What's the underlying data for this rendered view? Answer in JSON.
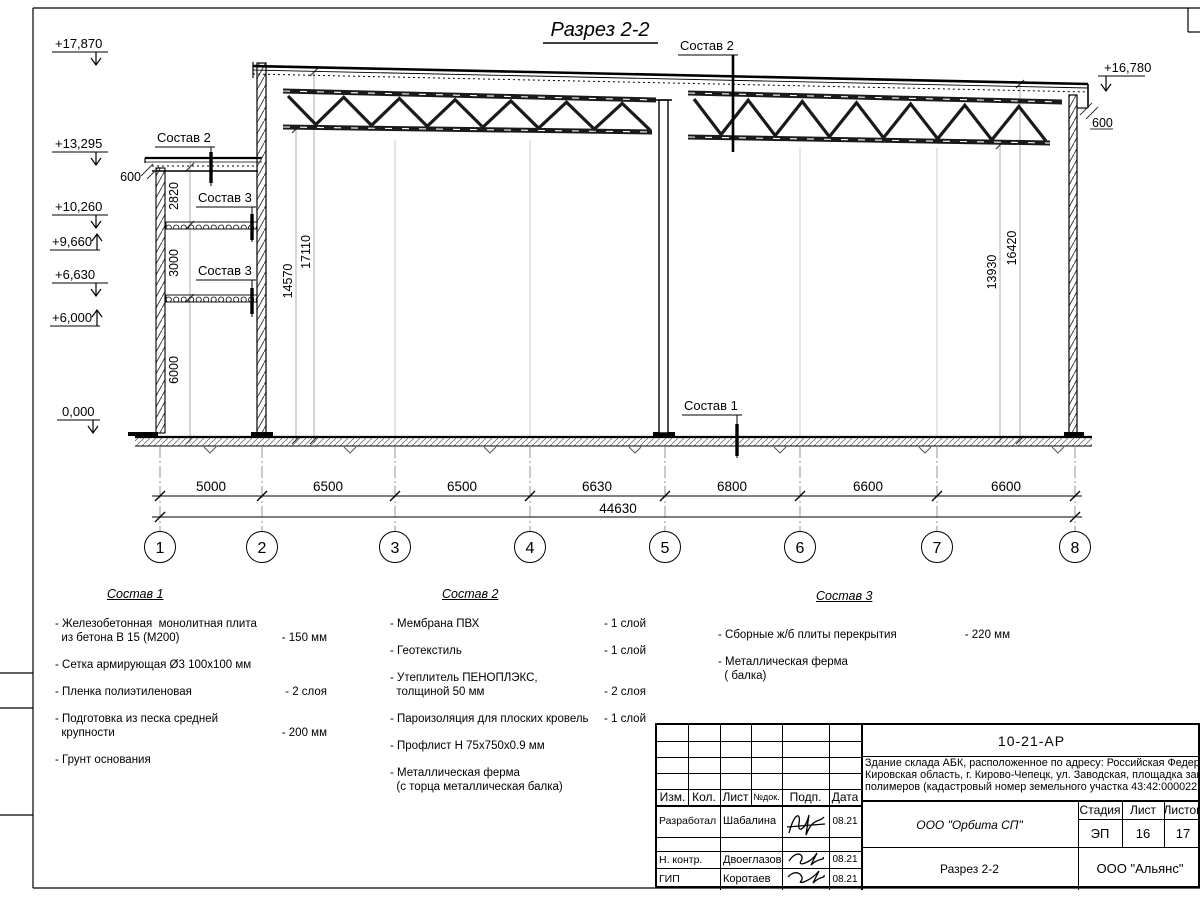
{
  "drawing": {
    "title": "Разрез 2-2",
    "elevation_marks": {
      "m17870": "+17,870",
      "m13295": "+13,295",
      "m10260": "+10,260",
      "m9660": "+9,660",
      "m6630": "+6,630",
      "m6000": "+6,000",
      "m0": "0,000",
      "m16780": "+16,780"
    },
    "callouts": {
      "sostav1": "Состав 1",
      "sostav2_left": "Состав 2",
      "sostav2_main": "Состав 2",
      "sostav3_upper": "Состав 3",
      "sostav3_lower": "Состав 3",
      "edge_left": "600",
      "edge_right": "600"
    },
    "dims_vertical": {
      "annex_top": "2820",
      "annex_mid": "3000",
      "annex_bottom": "6000",
      "left_clear": "14570",
      "left_full": "17110",
      "right_clear": "13930",
      "right_full": "16420"
    },
    "dims_horizontal": {
      "spans": [
        "5000",
        "6500",
        "6500",
        "6630",
        "6800",
        "6600",
        "6600"
      ],
      "total": "44630"
    },
    "axes": [
      "1",
      "2",
      "3",
      "4",
      "5",
      "6",
      "7",
      "8"
    ]
  },
  "legend": {
    "sostav1": {
      "title": "Состав 1",
      "items": [
        {
          "name": "- Железобетонная  монолитная плита\n  из бетона В 15 (М200)",
          "value": "- 150 мм"
        },
        {
          "name": "- Сетка армирующая Ø3 100х100 мм",
          "value": ""
        },
        {
          "name": "- Пленка полиэтиленовая",
          "value": "-  2 слоя"
        },
        {
          "name": "- Подготовка из песка средней\n  крупности",
          "value": "- 200 мм"
        },
        {
          "name": "- Грунт основания",
          "value": ""
        }
      ]
    },
    "sostav2": {
      "title": "Состав 2",
      "items": [
        {
          "name": "- Мембрана ПВХ",
          "value": "- 1 слой"
        },
        {
          "name": "- Геотекстиль",
          "value": "- 1 слой"
        },
        {
          "name": "- Утеплитель ПЕНОПЛЭКС,\n  толщиной 50 мм",
          "value": "- 2 слоя"
        },
        {
          "name": "- Пароизоляция для плоских кровель",
          "value": "- 1 слой"
        },
        {
          "name": "- Профлист Н 75х750х0.9 мм",
          "value": ""
        },
        {
          "name": "- Металлическая ферма\n  (с торца металлическая балка)",
          "value": ""
        }
      ]
    },
    "sostav3": {
      "title": "Состав 3",
      "items": [
        {
          "name": "- Сборные ж/б плиты перекрытия",
          "value": "- 220 мм"
        },
        {
          "name": "- Металлическая ферма\n  ( балка)",
          "value": ""
        }
      ]
    }
  },
  "titleblock": {
    "doc_number": "10-21-АР",
    "description": "Здание склада АБК, расположенное по адресу: Российская Федера\nКировская область, г. Кирово-Чепецк, ул. Заводская, площадка заво\nполимеров (кадастровый номер земельного участка 43:42:000022:3",
    "header": {
      "izm": "Изм.",
      "kol": "Кол.",
      "list": "Лист",
      "ndok": "№док.",
      "podp": "Подп.",
      "data": "Дата"
    },
    "rows": [
      {
        "role": "Разработал",
        "name": "Шабалина",
        "date": "08.21"
      },
      {
        "role": "Н. контр.",
        "name": "Двоеглазов",
        "date": "08.21"
      },
      {
        "role": "ГИП",
        "name": "Коротаев",
        "date": "08.21"
      }
    ],
    "org": "ООО \"Орбита СП\"",
    "drawing_name": "Разрез 2-2",
    "stage_label": "Стадия",
    "sheet_label": "Лист",
    "sheets_label": "Листов",
    "stage": "ЭП",
    "sheet": "16",
    "sheets": "17",
    "contractor": "ООО \"Альянс\""
  }
}
